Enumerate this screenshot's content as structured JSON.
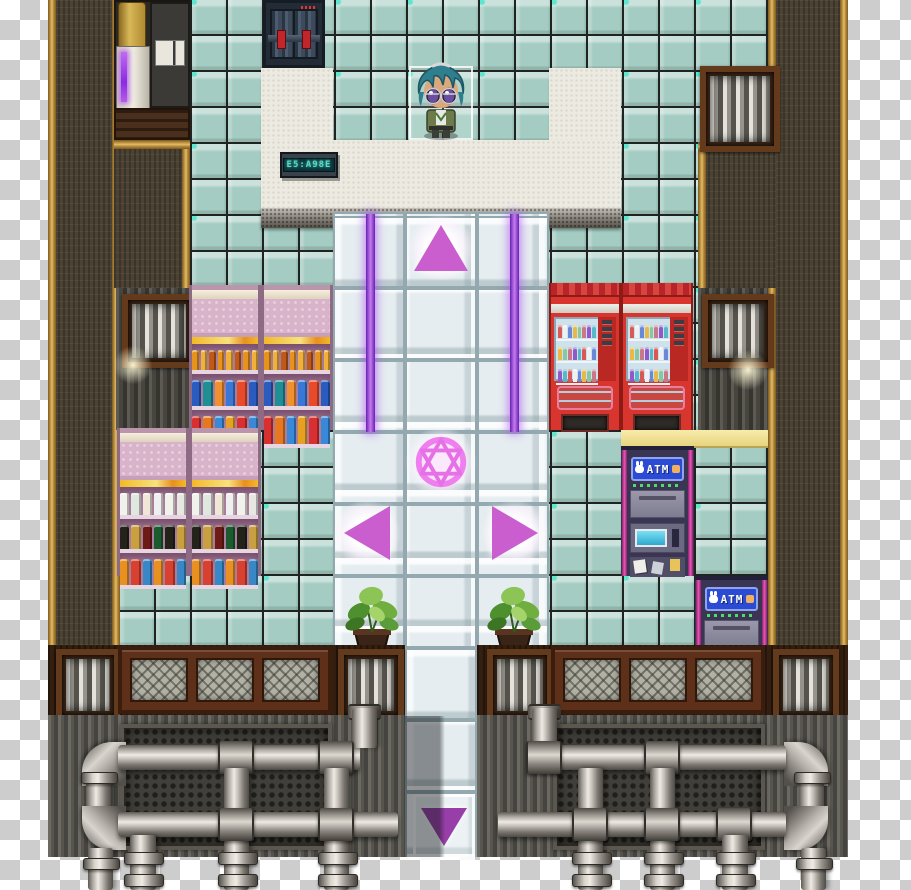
{
  "app": {
    "type": "pixel RPG interior map (transparent PNG over checkerboard)",
    "canvas": {
      "width": 911,
      "height": 890
    }
  },
  "palette": {
    "transparency_light": "#ffffff",
    "transparency_dark": "#cdcdcd",
    "tile_teal": "#a4ccc2",
    "floor_white": "#edeae2",
    "walkway_tile": "#e5edf0",
    "wall_brown": "#4b4233",
    "wall_trim_gold": "#c79d48",
    "beam_purple": "#a44fe0",
    "arrow_pink": "#ca5ecf",
    "arrow_down_purple": "#973ea8",
    "magic_circle_pink": "#ef7fef",
    "shelf_pink": "#d9b3c9",
    "vending_red": "#d8352f",
    "atm_sign_blue": "#2b4bd4",
    "atm_magenta": "#e858b8",
    "metal_wall": "#57554e",
    "pipe_silver": "#c7c2bb",
    "wood_frame": "#5e3019"
  },
  "objects": {
    "door": {
      "kind": "barred security double door",
      "red_clamps": 2
    },
    "led_sign": {
      "text": "E5:A98E"
    },
    "player": {
      "hair_color": "#2e7e8e",
      "eyes": "purple, glasses",
      "outfit": "green uniform",
      "facing": "down",
      "selected": true
    },
    "teleporter": {
      "magic_circle": "hexagram in circle",
      "arrows": [
        "up",
        "left",
        "right",
        "down"
      ]
    },
    "atms": {
      "count": 2,
      "label": "ATM"
    },
    "drink_machines": {
      "count": 2,
      "color": "red"
    },
    "plants": {
      "count": 2
    },
    "vents": {
      "wall_vents": 3,
      "band_vents": 4
    },
    "shelf_upper": {
      "rows": [
        {
          "h": 20,
          "w": 7,
          "items": [
            "#e8921e",
            "#f0b03a",
            "#c05818",
            "#e8921e",
            "#f0b03a",
            "#c05818",
            "#e8921e",
            "#f0b03a"
          ]
        },
        {
          "h": 26,
          "w": 10,
          "items": [
            "#2a5bbf",
            "#1f8f96",
            "#f09030",
            "#3a78d8",
            "#e84a2a",
            "#2a5bbf"
          ]
        },
        {
          "h": 28,
          "w": 10,
          "items": [
            "#d83030",
            "#e87820",
            "#3a88d8",
            "#e8a020",
            "#d83030",
            "#3a88d8"
          ]
        }
      ]
    },
    "shelf_lower": {
      "rows": [
        {
          "h": 22,
          "w": 10,
          "items": [
            "#f2f2ec",
            "#dfe8df",
            "#f2e6d8",
            "#efefef",
            "#f2f2ec",
            "#e8e8e2"
          ]
        },
        {
          "h": 24,
          "w": 10,
          "items": [
            "#23231a",
            "#c8a040",
            "#6e1a16",
            "#1a5c2e",
            "#23231a",
            "#c8a040"
          ]
        },
        {
          "h": 26,
          "w": 10,
          "items": [
            "#e89020",
            "#d84030",
            "#3888c8",
            "#e89020",
            "#d84030",
            "#3888c8"
          ]
        }
      ]
    },
    "vending_window": {
      "rows": 3,
      "per_row": 8,
      "bottle_colors": [
        "#d85858",
        "#f0f0f0",
        "#6888d8",
        "#e8b848",
        "#88c8a0",
        "#c87888",
        "#9058c8",
        "#58b8c8"
      ]
    },
    "pipes": {
      "left": [
        {
          "t": "eltl",
          "x": 82,
          "y": 742,
          "w": 44,
          "h": 44
        },
        {
          "t": "h",
          "x": 118,
          "y": 745,
          "w": 242,
          "h": 25
        },
        {
          "t": "v",
          "x": 86,
          "y": 780,
          "w": 25,
          "h": 30
        },
        {
          "t": "fl",
          "x": 81,
          "y": 772,
          "w": 35,
          "h": 10
        },
        {
          "t": "elbl",
          "x": 82,
          "y": 806,
          "w": 44,
          "h": 44
        },
        {
          "t": "h",
          "x": 118,
          "y": 812,
          "w": 280,
          "h": 25
        },
        {
          "t": "sv",
          "x": 348,
          "y": 704,
          "w": 33,
          "h": 12
        },
        {
          "t": "v",
          "x": 352,
          "y": 708,
          "w": 25,
          "h": 40
        },
        {
          "t": "sh",
          "x": 218,
          "y": 741,
          "w": 32,
          "h": 33
        },
        {
          "t": "sh",
          "x": 318,
          "y": 741,
          "w": 32,
          "h": 33
        },
        {
          "t": "v",
          "x": 224,
          "y": 768,
          "w": 25,
          "h": 122
        },
        {
          "t": "v",
          "x": 324,
          "y": 768,
          "w": 25,
          "h": 122
        },
        {
          "t": "sh",
          "x": 218,
          "y": 808,
          "w": 32,
          "h": 33
        },
        {
          "t": "sh",
          "x": 318,
          "y": 808,
          "w": 32,
          "h": 33
        },
        {
          "t": "v",
          "x": 130,
          "y": 835,
          "w": 26,
          "h": 55
        },
        {
          "t": "v",
          "x": 88,
          "y": 848,
          "w": 25,
          "h": 42
        },
        {
          "t": "fl",
          "x": 124,
          "y": 852,
          "w": 38,
          "h": 11
        },
        {
          "t": "fl",
          "x": 218,
          "y": 852,
          "w": 38,
          "h": 11
        },
        {
          "t": "fl",
          "x": 318,
          "y": 852,
          "w": 38,
          "h": 11
        },
        {
          "t": "fl",
          "x": 83,
          "y": 858,
          "w": 35,
          "h": 10
        },
        {
          "t": "fl",
          "x": 124,
          "y": 874,
          "w": 38,
          "h": 11
        },
        {
          "t": "fl",
          "x": 218,
          "y": 874,
          "w": 38,
          "h": 11
        },
        {
          "t": "fl",
          "x": 318,
          "y": 874,
          "w": 38,
          "h": 11
        }
      ],
      "right": [
        {
          "t": "eltr",
          "x": 784,
          "y": 742,
          "w": 44,
          "h": 44
        },
        {
          "t": "h",
          "x": 548,
          "y": 745,
          "w": 238,
          "h": 25
        },
        {
          "t": "v",
          "x": 799,
          "y": 780,
          "w": 25,
          "h": 30
        },
        {
          "t": "fl",
          "x": 794,
          "y": 772,
          "w": 35,
          "h": 10
        },
        {
          "t": "elbr",
          "x": 784,
          "y": 806,
          "w": 44,
          "h": 44
        },
        {
          "t": "h",
          "x": 498,
          "y": 812,
          "w": 288,
          "h": 25
        },
        {
          "t": "sv",
          "x": 528,
          "y": 704,
          "w": 33,
          "h": 12
        },
        {
          "t": "v",
          "x": 532,
          "y": 708,
          "w": 25,
          "h": 40
        },
        {
          "t": "sh",
          "x": 526,
          "y": 741,
          "w": 32,
          "h": 33
        },
        {
          "t": "sh",
          "x": 644,
          "y": 741,
          "w": 32,
          "h": 33
        },
        {
          "t": "v",
          "x": 578,
          "y": 768,
          "w": 25,
          "h": 122
        },
        {
          "t": "v",
          "x": 650,
          "y": 768,
          "w": 25,
          "h": 122
        },
        {
          "t": "sh",
          "x": 572,
          "y": 808,
          "w": 32,
          "h": 33
        },
        {
          "t": "sh",
          "x": 644,
          "y": 808,
          "w": 32,
          "h": 33
        },
        {
          "t": "sh",
          "x": 716,
          "y": 808,
          "w": 32,
          "h": 33
        },
        {
          "t": "v",
          "x": 722,
          "y": 835,
          "w": 26,
          "h": 55
        },
        {
          "t": "v",
          "x": 801,
          "y": 848,
          "w": 25,
          "h": 42
        },
        {
          "t": "fl",
          "x": 572,
          "y": 852,
          "w": 38,
          "h": 11
        },
        {
          "t": "fl",
          "x": 644,
          "y": 852,
          "w": 38,
          "h": 11
        },
        {
          "t": "fl",
          "x": 716,
          "y": 852,
          "w": 38,
          "h": 11
        },
        {
          "t": "fl",
          "x": 796,
          "y": 858,
          "w": 35,
          "h": 10
        },
        {
          "t": "fl",
          "x": 572,
          "y": 874,
          "w": 38,
          "h": 11
        },
        {
          "t": "fl",
          "x": 644,
          "y": 874,
          "w": 38,
          "h": 11
        },
        {
          "t": "fl",
          "x": 716,
          "y": 874,
          "w": 38,
          "h": 11
        }
      ]
    }
  }
}
